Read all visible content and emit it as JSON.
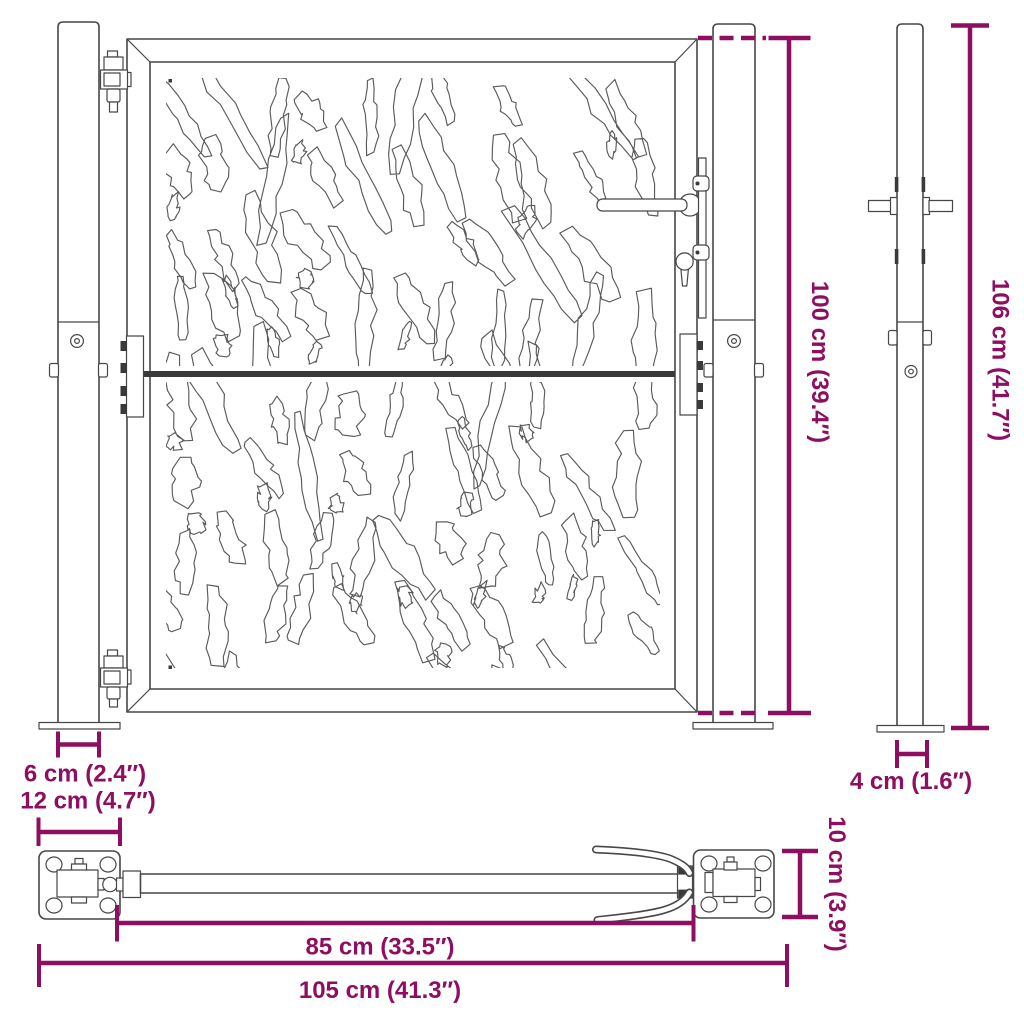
{
  "dimensions": {
    "gate_height": "100 cm (39.4″)",
    "post_height": "106 cm (41.7″)",
    "post_front_width": "6 cm (2.4″)",
    "base_plate_width": "12 cm (4.7″)",
    "post_side_width": "4 cm (1.6″)",
    "opening_width": "85 cm (33.5″)",
    "total_width": "105 cm (41.3″)",
    "base_plate_depth": "10 cm (3.9″)"
  },
  "colors": {
    "dimension_accent": "#8E0E60",
    "drawing_line": "#474747",
    "background": "#FFFFFF"
  }
}
